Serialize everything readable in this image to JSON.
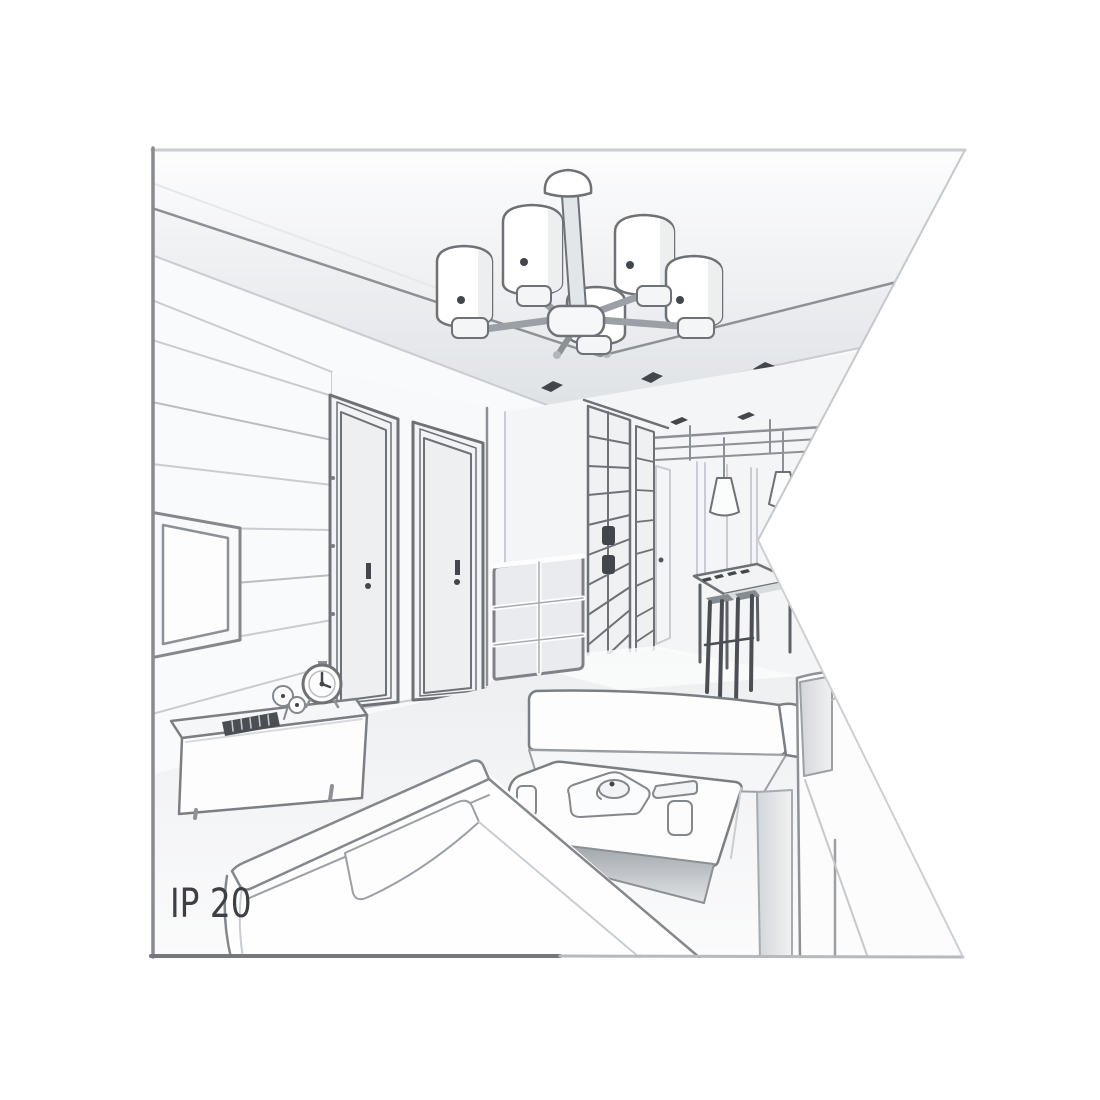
{
  "canvas": {
    "width": 1100,
    "height": 1100,
    "background": "#ffffff"
  },
  "label": {
    "ip_rating": "IP 20"
  },
  "palette": {
    "line_dark": "#6e7276",
    "line_mid": "#8d9195",
    "line_light": "#c9cdd1",
    "fill_white": "#ffffff",
    "fill_panel": "#f1f2f4",
    "fill_mid": "#e4e6e9",
    "shade_dark": "#999fa4",
    "accent_dark": "#43474b",
    "text_color": "#3c3f43",
    "border_dark": "#7c8084",
    "border_light": "#c9ccd0"
  },
  "scene": {
    "objects": [
      "ceiling-chandelier",
      "recessed-ceiling",
      "ceiling-downlights",
      "slat-tv-wall",
      "wall-mounted-tv",
      "interior-door-left",
      "interior-door-right",
      "drawer-chest",
      "lattice-wardrobe",
      "hallway-pendant-lamps",
      "dining-table-with-chairs",
      "tv-sideboard",
      "alarm-clock",
      "flower-decor",
      "soundbar",
      "sofa-foreground",
      "sofa-right",
      "armchair",
      "coffee-table",
      "coffee-table-decor"
    ]
  }
}
